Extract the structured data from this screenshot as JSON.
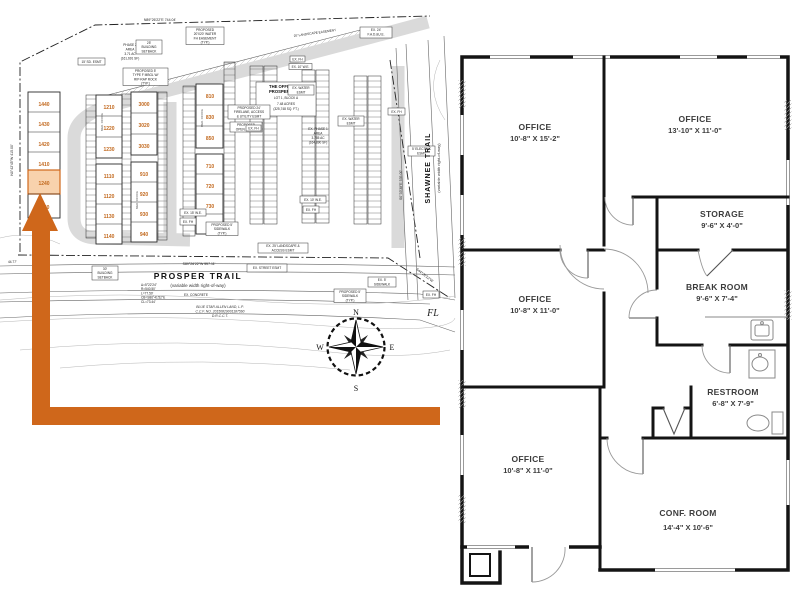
{
  "site_plan": {
    "streets": {
      "prosper_trail": "PROSPER TRAIL",
      "prosper_trail_sub": "(variable width right-of-way)",
      "shawnee_trail": "SHAWNEE TRAIL",
      "shawnee_trail_sub": "(variable width right-of-way)"
    },
    "development": {
      "title_line1": "THE OFFICES AT",
      "title_line2": "PROSPER TRAIL",
      "lot": "LOT 1, BLOCK A",
      "acreage": "7.48 ACRES",
      "acreage_sf": "(325,748 SQ. FT.)",
      "phase2": [
        "PHASE 2",
        "AREA",
        "3.71 AC",
        "(161,691 SF)"
      ],
      "phase1": [
        "EX. PHASE 1",
        "AREA",
        "3.785 AC",
        "(164,890 SF)"
      ]
    },
    "units": {
      "building1_top": [
        "1440",
        "1430",
        "1420",
        "1410"
      ],
      "highlighted_unit": "1240",
      "building1_bottom": [
        "1140"
      ],
      "building2_top": [
        "1210",
        "1220",
        "1230"
      ],
      "building2_bottom": [
        "1110",
        "1120",
        "1130",
        "1140"
      ],
      "building3_top": [
        "3000",
        "3020",
        "3030"
      ],
      "building3_bottom": [
        "910",
        "920",
        "930",
        "940"
      ],
      "building4_top": [
        "810",
        "830",
        "850"
      ],
      "building4_bottom": [
        "710",
        "720",
        "730",
        "790"
      ],
      "med_office": "MED. OFFICE"
    },
    "annotations": {
      "setback25": [
        "25'",
        "BUILDING",
        "SETBACK"
      ],
      "water_fh": [
        "PROPOSED",
        "20'X20' WATER",
        "FH EASEMENT",
        "(TYP.)"
      ],
      "rip_rap": [
        "PROPOSED 5'",
        "TYPE F MBGL W/",
        "RIP-RAP ROCK",
        "(TYP.)"
      ],
      "sd_esmt": "15' SD. ESMT",
      "landscape25": "25' LANDSCAPE EASEMENT",
      "fadue": [
        "EX. 24'",
        "F.A.D.&U.E."
      ],
      "firelane": [
        "PROPOSED 24'",
        "FIRELANE, ACCESS",
        "& UTILITY ESMT"
      ],
      "open_space": [
        "PROPOSED",
        "OPEN SPACE"
      ],
      "ex_water": [
        "EX. WATER",
        "ESMT"
      ],
      "ex_fh": "EX. FH",
      "electric": [
        "5' ELECTRIC",
        "ESMT"
      ],
      "ex_10_we": "EX. 10' W.E.",
      "ex_15_we": "EX. 15' W.E.",
      "proposed_sidewalk": [
        "PROPOSED 5'",
        "SIDEWALK",
        "(TYP.)"
      ],
      "ex_landscape_access": [
        "EX. 25' LANDSCAPE &",
        "ACCESS ESMT"
      ],
      "ex_street": "EX. STREET ESMT",
      "ex_sidewalk": [
        "EX. 5'",
        "SIDEWALK"
      ],
      "setback30": [
        "30'",
        "BUILDING",
        "SETBACK"
      ],
      "ex_concrete": "EX. CONCRETE",
      "fl": "FL"
    },
    "bearings": {
      "north_line": "N89°26'22\"E  744.04'",
      "south_line": "S89°26'22\"W  557.11'",
      "east_line": "S0°33'38\"E  535.00'",
      "southeast": "S44°26'22\"W",
      "west_line": "N0°42'45\"W  415.00'",
      "dim_4477": "44.77'",
      "curve_lines": [
        "Δ=5°22'24\"",
        "R=540.50'",
        "L=77.50'",
        "CB=S86°41'52\"E",
        "CL=73.44'"
      ]
    },
    "owner": {
      "line1": "BLUE STAR ALLEN LAND, L.P.",
      "line2": "C.C.F. NO. 20150829001187560",
      "line3": "D.R.C.C.T."
    },
    "compass": {
      "north": "N",
      "south": "S",
      "east": "E",
      "west": "W"
    },
    "colors": {
      "arrow": "#cf671b",
      "highlight_fill": "#f8d2ad",
      "unit_text": "#c2691e"
    }
  },
  "floor_plan": {
    "rooms": [
      {
        "name": "OFFICE",
        "dims": "10'-8\" X 15'-2\""
      },
      {
        "name": "OFFICE",
        "dims": "13'-10\" X 11'-0\""
      },
      {
        "name": "STORAGE",
        "dims": "9'-6\" X 4'-0\""
      },
      {
        "name": "BREAK ROOM",
        "dims": "9'-6\" X 7'-4\""
      },
      {
        "name": "OFFICE",
        "dims": "10'-8\" X 11'-0\""
      },
      {
        "name": "RESTROOM",
        "dims": "6'-8\" X 7'-9\""
      },
      {
        "name": "OFFICE",
        "dims": "10'-8\" X 11'-0\""
      },
      {
        "name": "CONF. ROOM",
        "dims": "14'-4\" X 10'-6\""
      }
    ]
  }
}
